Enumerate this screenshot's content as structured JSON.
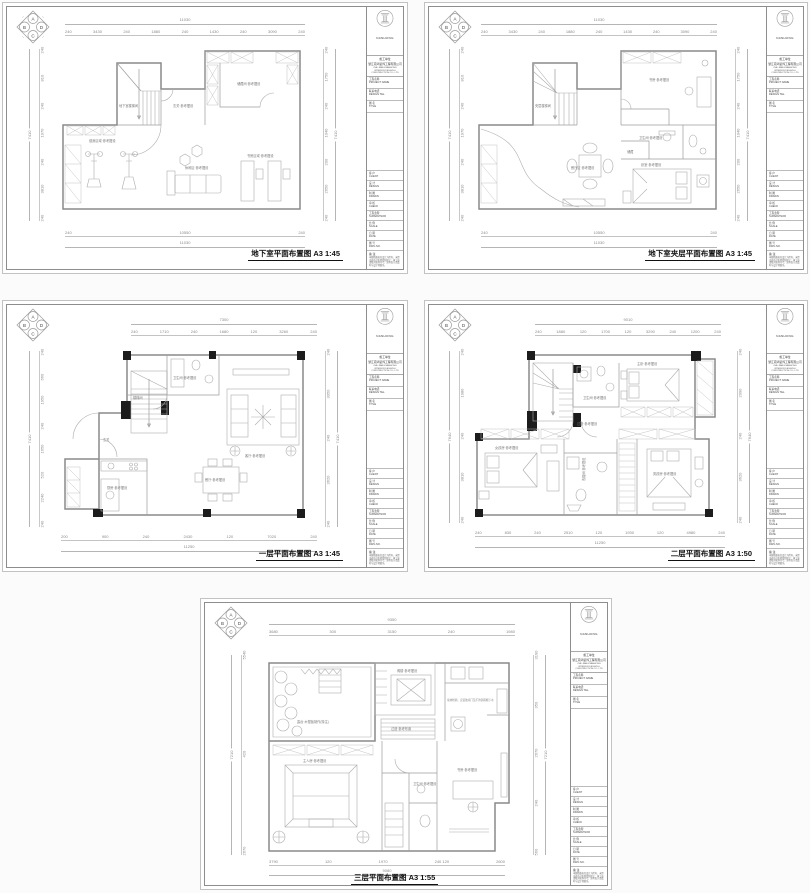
{
  "titleblock": {
    "logo": "NANHONG",
    "firm_cn": "施工单位",
    "company_cn": "浙江南鸿装饰工程有限公司",
    "company_en": "ZHE JIANG NANHONG INTERIOR DESIGN & CONSTRUCTION CO., LTD",
    "fields": [
      "工程名称\nPROJECT NAME",
      "联系电话\nDESIGN TEL.",
      "图  名\nTITLE"
    ],
    "rows": [
      "客  户\nCLIENT",
      "设  计\nDESIGN",
      "制  图\nDRAWN",
      "审  核\nCHECK",
      "工程监理\nSUPERVISOR",
      "比  例\nSCALE",
      "日  期\nDATE",
      "图  号\nDWG NO."
    ],
    "notes_title": "备  注",
    "notes": "本图纸版权归设计方所有，未经书面许可不得复制转让；施工前请核对现场尺寸，如有出入请及时与设计师联系。"
  },
  "compass": [
    "A",
    "B",
    "C",
    "D"
  ],
  "sheets": [
    {
      "title": "地下室平面布置图 A3 1:45",
      "dims": {
        "top_total": "11030",
        "top_segs": [
          "240",
          "3430",
          "240",
          "1880",
          "240",
          "1430",
          "240",
          "3090",
          "240"
        ],
        "bottom_segs": [
          "240",
          "10550",
          "240"
        ],
        "bottom_total": "11030",
        "left_total": "7410",
        "left_segs": [
          "240",
          "810",
          "240",
          "1970",
          "240",
          "3810",
          "240"
        ],
        "right_total": "7410",
        "right_segs": [
          "240",
          "1750",
          "240",
          "1040",
          "200",
          "2650",
          "240"
        ]
      },
      "rooms": {
        "r1": "地下室楼梯间",
        "r2": "玄关·参考摆设",
        "r3": "储藏间·参考摆设",
        "r4": "健身区域·参考摆设",
        "r5": "休闲区·参考摆设",
        "r6": "书房区域·参考摆设"
      }
    },
    {
      "title": "地下室夹层平面布置图 A3 1:45",
      "dims": {
        "top_total": "11030",
        "top_segs": [
          "240",
          "3430",
          "240",
          "1880",
          "240",
          "1430",
          "240",
          "3090",
          "240"
        ],
        "bottom_segs": [
          "240",
          "10550",
          "240"
        ],
        "bottom_total": "11030",
        "left_total": "7410",
        "left_segs": [
          "240",
          "810",
          "240",
          "1970",
          "240",
          "3810",
          "240"
        ],
        "right_total": "7410",
        "right_segs": [
          "240",
          "1750",
          "240",
          "1040",
          "200",
          "2650",
          "240"
        ]
      },
      "rooms": {
        "r1": "书房·参考摆设",
        "r2": "卫生间·参考摆设",
        "r3": "储藏",
        "r4": "餐厅区·参考摆设",
        "r5": "卧室·参考摆设",
        "r6": "夹层楼梯间"
      }
    },
    {
      "title": "一层平面布置图 A3 1:45",
      "dims": {
        "top_total": "7300",
        "top_segs": [
          "240",
          "1710",
          "240",
          "1680",
          "120",
          "3260",
          "240"
        ],
        "bottom_segs": [
          "200",
          "900",
          "240",
          "2430",
          "120",
          "7020",
          "240"
        ],
        "bottom_total": "11250",
        "left_total": "7410",
        "left_segs": [
          "240",
          "660",
          "1950",
          "240",
          "1650",
          "520",
          "2240",
          "240"
        ],
        "right_total": "7410",
        "right_segs": [
          "240",
          "3050",
          "240",
          "3620",
          "240"
        ]
      },
      "rooms": {
        "r1": "楼梯间",
        "r2": "卫生间·参考摆设",
        "r3": "客厅·参考摆设",
        "r4": "餐厅·参考摆设",
        "r5": "厨房·参考摆设",
        "r6": "玄关"
      }
    },
    {
      "title": "二层平面布置图 A3 1:50",
      "dims": {
        "top_total": "9010",
        "top_segs": [
          "240",
          "1880",
          "120",
          "1700",
          "120",
          "3290",
          "240",
          "1200",
          "240"
        ],
        "bottom_segs": [
          "240",
          "830",
          "240",
          "2510",
          "120",
          "1930",
          "120",
          "4980",
          "240"
        ],
        "bottom_total": "11250",
        "left_total": "7640",
        "left_segs": [
          "240",
          "1980",
          "240",
          "3810",
          "240"
        ],
        "right_total": "7640",
        "right_segs": [
          "240",
          "2090",
          "240",
          "3620",
          "240"
        ]
      },
      "rooms": {
        "r1": "卫生间·参考摆设",
        "r2": "主卧·参考摆设",
        "r3": "衣帽间·参考摆设",
        "r4": "女孩房·参考摆设",
        "r5": "过道·参考摆设",
        "r6": "男孩房·参考摆设"
      }
    },
    {
      "title": "三层平面布置图 A3 1:55",
      "dims": {
        "top_total": "9350",
        "top_segs": [
          "3680",
          "300",
          "3150",
          "240",
          "1980"
        ],
        "bottom_segs": [
          "3790",
          "120",
          "1970",
          "240 120",
          "2600"
        ],
        "bottom_total": "9080",
        "left_total": "7210",
        "left_segs": [
          "5540",
          "420",
          "2670"
        ],
        "right_total": "7210",
        "right_segs": [
          "3190",
          "350",
          "2670",
          "240",
          "560"
        ]
      },
      "rooms": {
        "r1": "露台·木塑板制作(特注)",
        "r2": "阁楼·参考摆设",
        "r3": "过道·参考布置",
        "r4": "主人房·参考摆设",
        "r5": "书房·参考摆设",
        "r6": "卫生间·参考摆设",
        "r7": "墙体粉刷，安装玻璃门及不锈钢雨棚下水"
      }
    }
  ]
}
